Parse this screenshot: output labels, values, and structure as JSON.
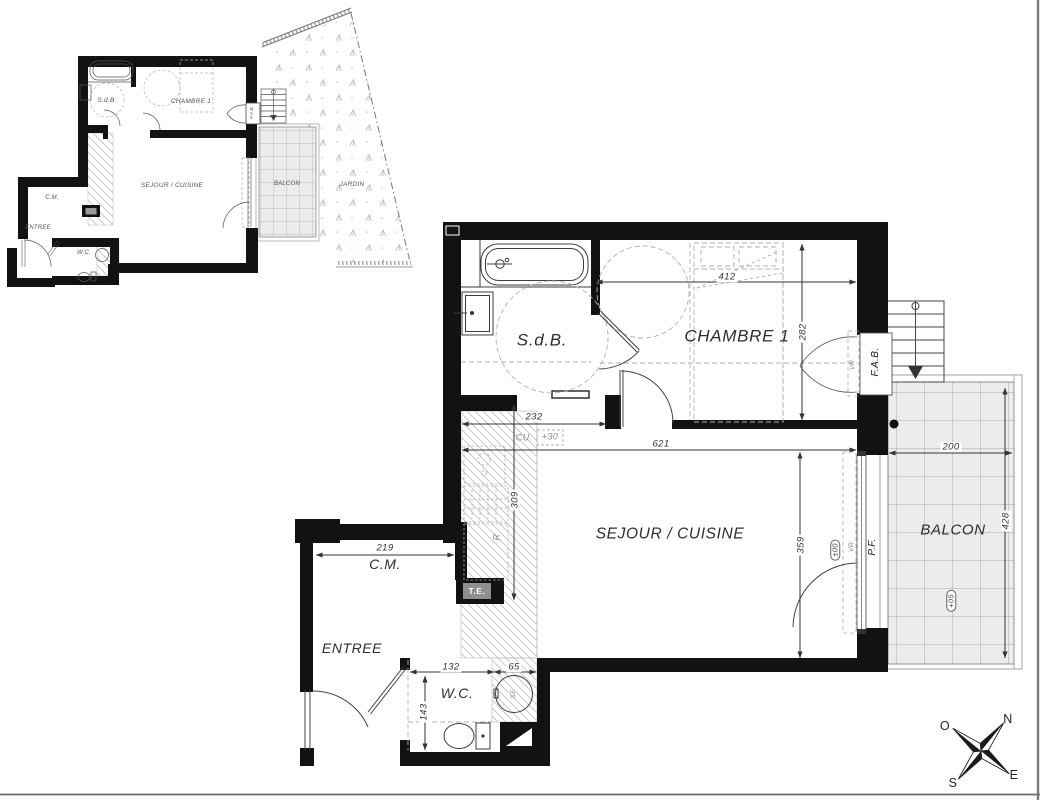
{
  "overview_plan": {
    "labels": {
      "sdb": "S.d.B.",
      "chambre": "CHAMBRE 1",
      "sejour": "SEJOUR / CUISINE",
      "cm": "C.M.",
      "entree": "ENTREE",
      "wc": "W.C.",
      "balcon": "BALCON",
      "jardin": "JARDIN",
      "fab": "F.A.B"
    }
  },
  "main_plan": {
    "rooms": {
      "sdb": "S.d.B.",
      "chambre": "CHAMBRE 1",
      "sejour": "SEJOUR / CUISINE",
      "cm": "C.M.",
      "entree": "ENTREE",
      "wc": "W.C.",
      "balcon": "BALCON"
    },
    "dimensions": {
      "chambre_width": "412",
      "chambre_depth": "282",
      "sdb_width": "232",
      "sejour_width": "621",
      "kitchen_depth": "309",
      "sejour_depth": "359",
      "balcon_width": "200",
      "balcon_depth": "428",
      "cm_width": "219",
      "wc_width": "132",
      "wc_niche": "65",
      "wc_depth": "143"
    },
    "annotations": {
      "cu": "CU.",
      "cu_level": "+30",
      "te": "T.E.",
      "fab": "F.A.B.",
      "pf": "P.F.",
      "vr": "VR",
      "level_main": "±00",
      "level_balcony": "+05",
      "fridge": "R",
      "washer": "SE"
    }
  },
  "compass": {
    "north": "N",
    "east": "E",
    "south": "S",
    "west": "O"
  }
}
